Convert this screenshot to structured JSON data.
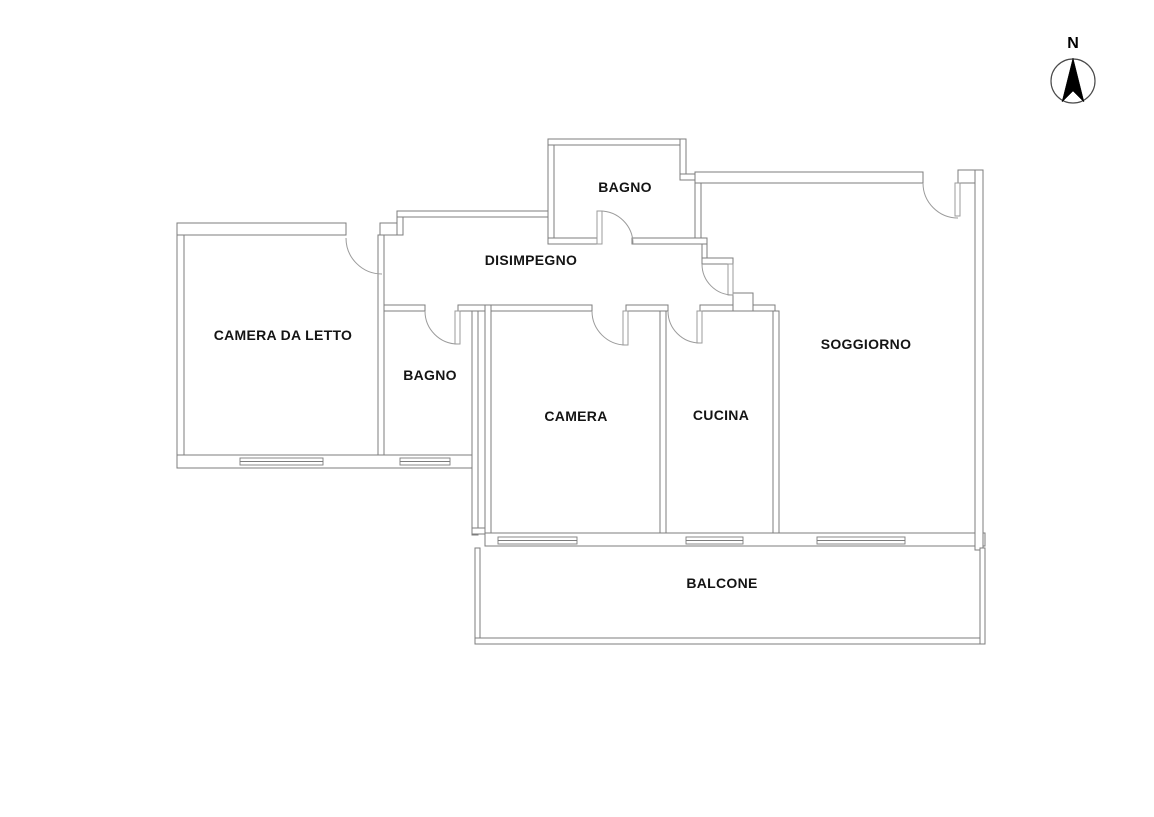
{
  "compass": {
    "label": "N"
  },
  "rooms": {
    "bagno_top": {
      "label": "BAGNO"
    },
    "disimpegno": {
      "label": "DISIMPEGNO"
    },
    "camera_da_letto": {
      "label": "CAMERA DA LETTO"
    },
    "bagno": {
      "label": "BAGNO"
    },
    "camera": {
      "label": "CAMERA"
    },
    "cucina": {
      "label": "CUCINA"
    },
    "soggiorno": {
      "label": "SOGGIORNO"
    },
    "balcone": {
      "label": "BALCONE"
    }
  },
  "colors": {
    "background": "#ffffff",
    "wall_line": "#7d7d7d",
    "door_arc": "#9b9b9b",
    "label_text": "#141414",
    "compass_arrow": "#000000"
  }
}
